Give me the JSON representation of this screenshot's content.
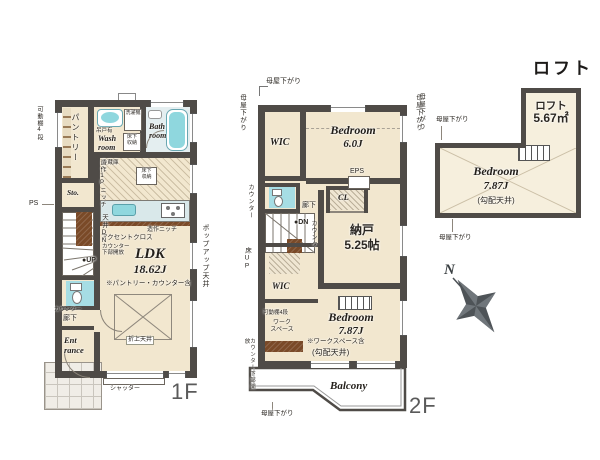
{
  "colors": {
    "wall": "#4f4b47",
    "room": "#f2e7cf",
    "room_light": "#f6efdd",
    "water": "#8fd7de",
    "water_pale": "#bde6ea",
    "wood": "#7a4a28",
    "counter": "#d9e8ea",
    "toilet_floor": "#a6dde4",
    "bath_floor": "#e4eef0",
    "label": "#2b2722",
    "floor_label": "#5a5a5a"
  },
  "f1": {
    "floor_label": "1F",
    "movable_shelf": "可動棚4段",
    "pantry": "パントリー",
    "hanging_cabinet": "吊戸有",
    "wash_room": "Wash\nroom",
    "washer": "洗濯機",
    "underfloor_storage": "床下\n収納",
    "bath_room": "Bath\nroom",
    "fridge": "冷蔵庫",
    "niche": "造作ニッチ",
    "accent_cloth": "アクセントクロス",
    "p_niche": "造作1Pニッチ",
    "ceiling_down": "天井DN",
    "counter_under_open": "カウンター\n下部開放",
    "up": "●UP",
    "sto": "Sto.",
    "ps": "PS",
    "ldk_name": "LDK",
    "ldk_size": "18.62J",
    "ldk_note": "※パントリー・カウンター含",
    "folded_ceiling": "折上天井",
    "popup_ceiling": "ポップアップ天井",
    "counter": "カウンター",
    "hallway": "廊下",
    "entrance": "Ent\nrance",
    "shutter": "シャッター"
  },
  "f2": {
    "floor_label": "2F",
    "moyasagari": "母屋下がり",
    "wic_upper": "WIC",
    "bedroom6_name": "Bedroom",
    "bedroom6_size": "6.0J",
    "eps": "EPS",
    "cl": "CL",
    "hallway": "廊下",
    "dn": "●DN",
    "counter": "カウンター",
    "storage_name": "納戸",
    "storage_size": "5.25帖",
    "floor_up": "床UP",
    "wic_lower": "WIC",
    "movable_shelf": "可動棚4段",
    "workspace": "ワーク\nスペース",
    "counter_under_open": "カウンター下部開放",
    "bedroom7_name": "Bedroom",
    "bedroom7_size": "7.87J",
    "bedroom7_note": "※ワークスペース含",
    "sloped_ceiling": "(勾配天井)",
    "balcony": "Balcony"
  },
  "loft": {
    "title": "ロフト",
    "name": "ロフト",
    "size": "5.67㎡",
    "bedroom_name": "Bedroom",
    "bedroom_size": "7.87J",
    "sloped_ceiling": "(勾配天井)",
    "moyasagari": "母屋下がり"
  },
  "compass": {
    "north": "N"
  }
}
